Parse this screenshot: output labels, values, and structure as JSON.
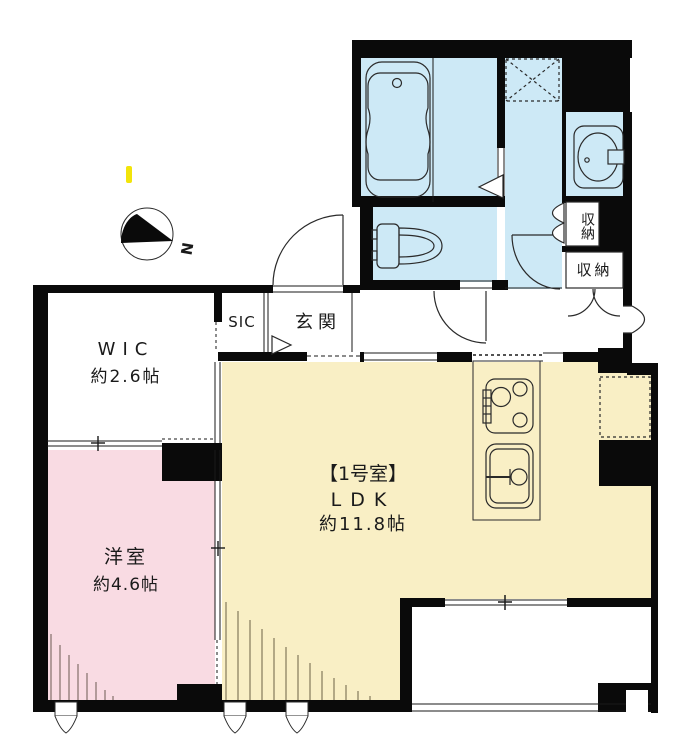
{
  "plan": {
    "title": "apartment floor plan",
    "rooms": {
      "wic": {
        "name": "WIC",
        "size": "約2.6帖"
      },
      "bedroom": {
        "name": "洋室",
        "size": "約4.6帖"
      },
      "ldk": {
        "unit": "【1号室】",
        "name": "LDK",
        "size": "約11.8帖"
      },
      "sic": {
        "name": "SIC"
      },
      "genkan": {
        "name": "玄関"
      },
      "storage1": {
        "name": "収納"
      },
      "storage2": {
        "name": "収納"
      }
    },
    "compass": {
      "north_label": "N"
    },
    "colors": {
      "water_area": "#cde9f6",
      "ldk_fill": "#f9efc5",
      "bedroom_fill": "#f9dbe3",
      "wall": "#0a0a0a",
      "highlight_mark": "#f2e40a"
    }
  }
}
